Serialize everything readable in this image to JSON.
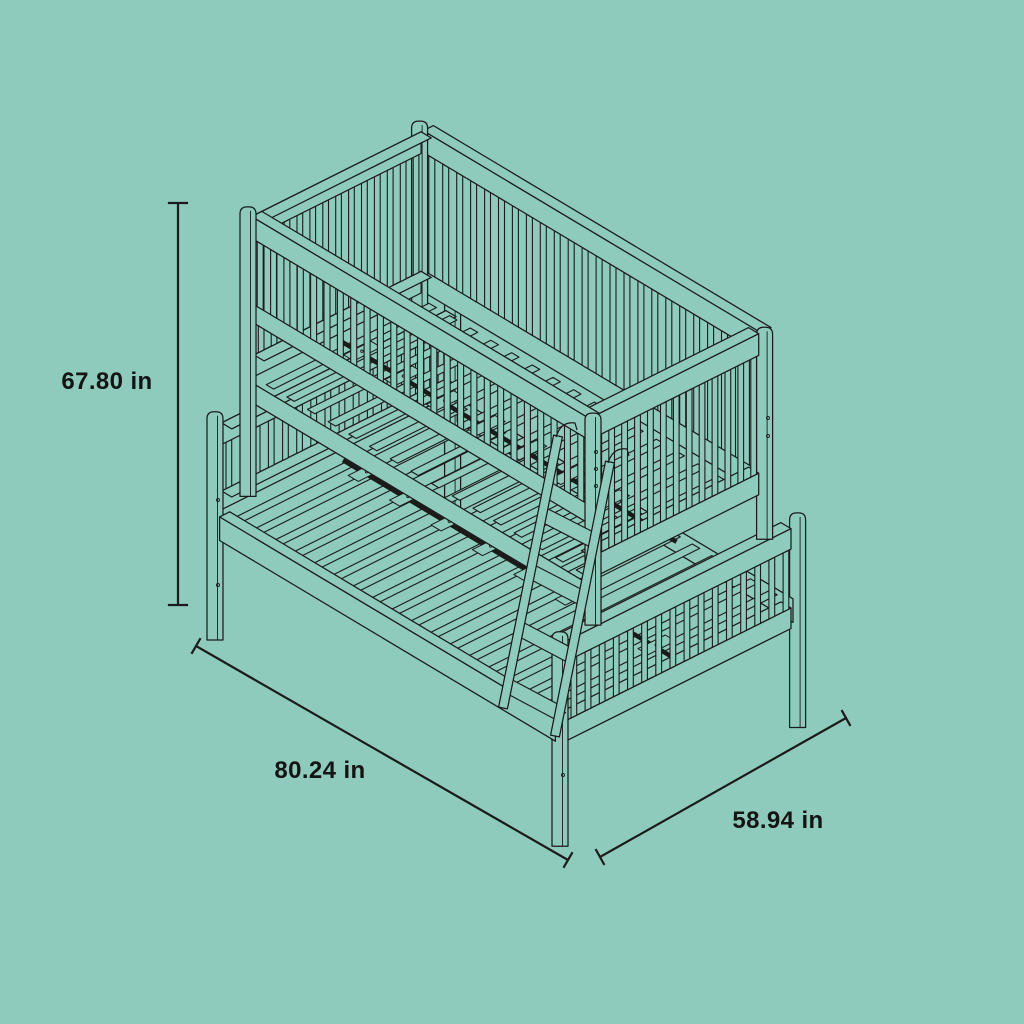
{
  "canvas": {
    "width": 1024,
    "height": 1024,
    "background": "#8ecbbc"
  },
  "style": {
    "line_color": "#1b1b1b",
    "label_color": "#141414"
  },
  "diagram": {
    "subject": "twin-over-full bunk bed isometric line drawing",
    "dimensions": [
      {
        "id": "height",
        "label": "67.80 in",
        "orientation": "vertical-left"
      },
      {
        "id": "length",
        "label": "80.24 in",
        "orientation": "diagonal-bottom-left"
      },
      {
        "id": "depth",
        "label": "58.94 in",
        "orientation": "diagonal-bottom-right"
      }
    ]
  }
}
